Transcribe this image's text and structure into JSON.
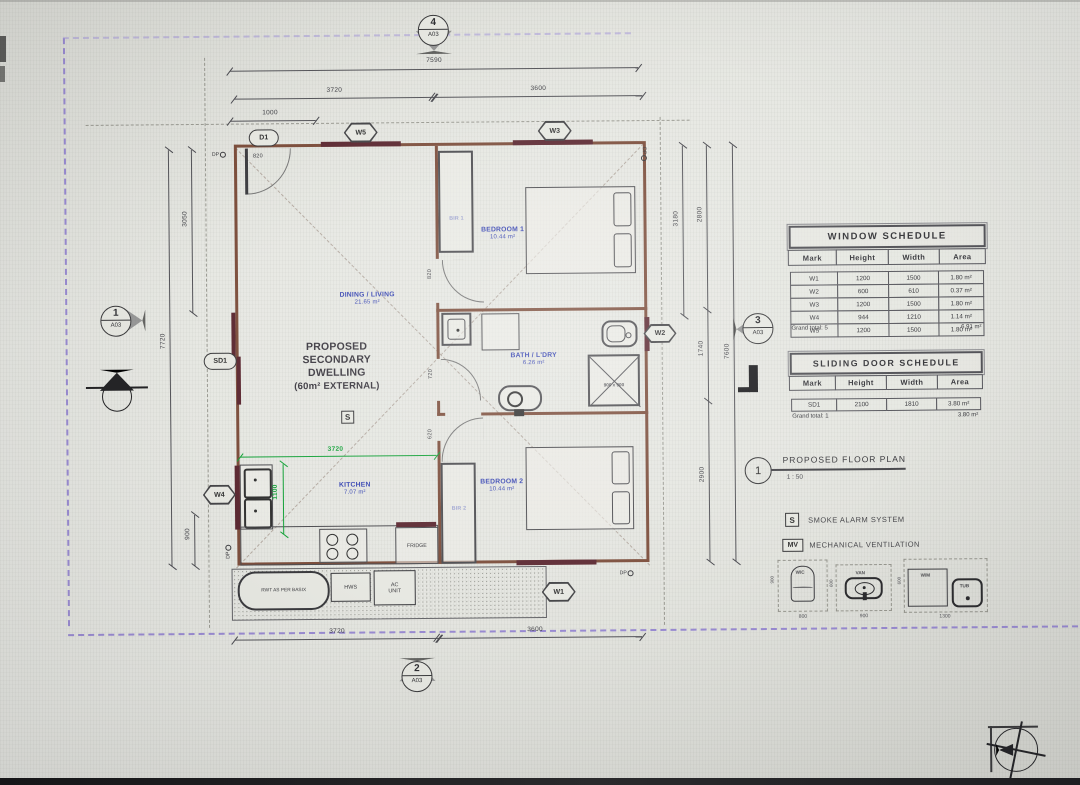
{
  "plan": {
    "tags": {
      "d1": "D1",
      "w5": "W5",
      "w3": "W3",
      "sd1": "SD1",
      "w4": "W4",
      "w2": "W2",
      "w1": "W1"
    },
    "dp_label": "DP",
    "section_markers": {
      "top": {
        "num": "4",
        "sheet": "A03"
      },
      "left": {
        "num": "1",
        "sheet": "A03"
      },
      "right": {
        "num": "3",
        "sheet": "A03"
      },
      "bottom": {
        "num": "2",
        "sheet": "A03"
      }
    },
    "dims": {
      "top_total": "7590",
      "top_left": "3720",
      "top_right": "3600",
      "top_small": "1000",
      "bottom_left": "3720",
      "bottom_right": "3600",
      "left_total": "7720",
      "left_upper": "3050",
      "left_lower": "900",
      "right_inner": "3180",
      "right_upper": "2800",
      "right_mid": "1740",
      "right_lower": "2900",
      "right_total": "7600",
      "kitchen_w": "3720",
      "kitchen_h": "1100",
      "door_entry": "820",
      "door_bed1": "820",
      "door_bath": "720",
      "door_bed2": "620"
    },
    "rooms": {
      "dining": {
        "name": "DINING / LIVING",
        "area": "21.65 m²"
      },
      "bedroom1": {
        "name": "BEDROOM 1",
        "area": "10.44 m²"
      },
      "bath": {
        "name": "BATH / L'DRY",
        "area": "6.26 m²"
      },
      "kitchen": {
        "name": "KITCHEN",
        "area": "7.07 m²"
      },
      "bedroom2": {
        "name": "BEDROOM 2",
        "area": "10.44 m²"
      },
      "bir1": "BIR 1",
      "bir2": "BIR 2"
    },
    "building_label": {
      "l1": "PROPOSED",
      "l2": "SECONDARY",
      "l3": "DWELLING",
      "l4": "(60m² EXTERNAL)",
      "smoke": "S"
    },
    "fixtures": {
      "fridge": "FRIDGE",
      "shower_size": "900 x 900"
    },
    "exterior": {
      "tank": "RWT AS PER BASIX",
      "hws": "HWS",
      "ac_line1": "AC",
      "ac_line2": "UNIT"
    }
  },
  "panel": {
    "window_schedule": {
      "title": "WINDOW SCHEDULE",
      "headers": [
        "Mark",
        "Height",
        "Width",
        "Area"
      ],
      "rows": [
        {
          "mark": "W1",
          "height": "1200",
          "width": "1500",
          "area": "1.80 m²"
        },
        {
          "mark": "W2",
          "height": "600",
          "width": "610",
          "area": "0.37 m²"
        },
        {
          "mark": "W3",
          "height": "1200",
          "width": "1500",
          "area": "1.80 m²"
        },
        {
          "mark": "W4",
          "height": "944",
          "width": "1210",
          "area": "1.14 m²"
        },
        {
          "mark": "W5",
          "height": "1200",
          "width": "1500",
          "area": "1.80 m²"
        }
      ],
      "grand_total": "Grand total: 5",
      "grand_area": "6.91 m²"
    },
    "door_schedule": {
      "title": "SLIDING DOOR SCHEDULE",
      "headers": [
        "Mark",
        "Height",
        "Width",
        "Area"
      ],
      "rows": [
        {
          "mark": "SD1",
          "height": "2100",
          "width": "1810",
          "area": "3.80 m²"
        }
      ],
      "grand_total": "Grand total: 1",
      "grand_area": "3.80 m²"
    },
    "callout": {
      "number": "1",
      "title": "PROPOSED FLOOR PLAN",
      "scale": "1 : 50"
    },
    "legend": {
      "smoke_symbol": "S",
      "smoke_label": "SMOKE ALARM SYSTEM",
      "mv_symbol": "MV",
      "mv_label": "MECHANICAL VENTILATION"
    },
    "fixture_legend": {
      "wc": {
        "label": "W/C",
        "width": "800",
        "height": "900"
      },
      "van": {
        "label": "VAN",
        "width": "900",
        "height": "600"
      },
      "wm": {
        "label": "W/M",
        "width": "1300",
        "height": "600"
      },
      "tub": {
        "label": "TUB"
      }
    }
  }
}
